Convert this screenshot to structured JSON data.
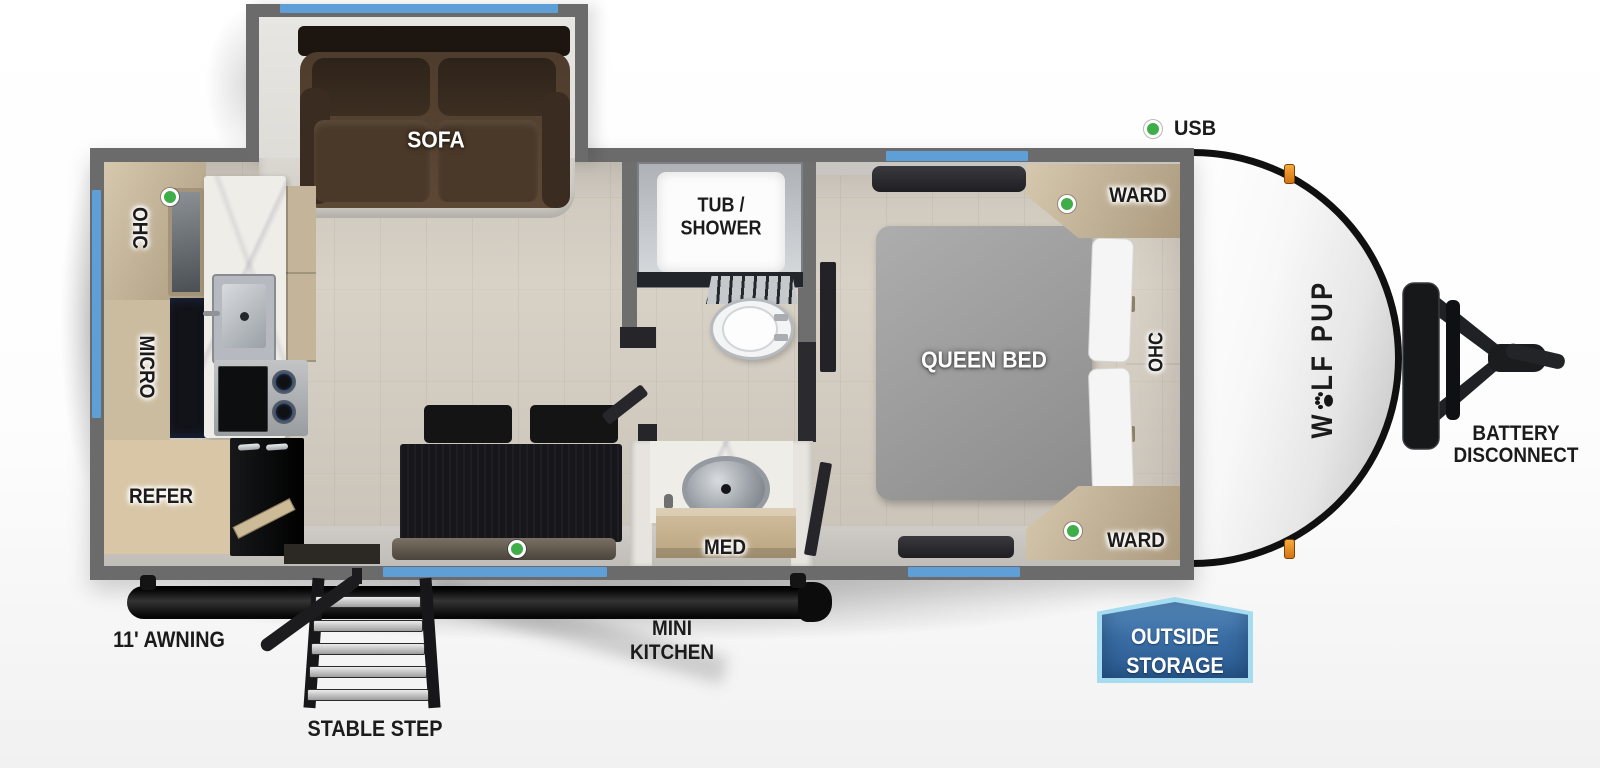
{
  "trailer": {
    "brand_logo": {
      "prefix": "W",
      "suffix": "LF PUP"
    },
    "rooms": {
      "living": {
        "sofa": "SOFA"
      },
      "kitchen": {
        "ohc": "OHC",
        "micro": "MICRO",
        "refer": "REFER"
      },
      "bath": {
        "tub_line1": "TUB /",
        "tub_line2": "SHOWER",
        "med": "MED"
      },
      "bedroom": {
        "bed": "QUEEN BED",
        "ward_top": "WARD",
        "ward_bottom": "WARD",
        "ohc": "OHC"
      }
    },
    "callouts": {
      "usb": "USB",
      "battery_line1": "BATTERY",
      "battery_line2": "DISCONNECT",
      "awning": "11' AWNING",
      "stable_step": "STABLE STEP",
      "mini_kitchen_line1": "MINI",
      "mini_kitchen_line2": "KITCHEN",
      "outside_storage_line1": "OUTSIDE",
      "outside_storage_line2": "STORAGE"
    },
    "colors": {
      "wall": "#6b6b6b",
      "window": "#5f9fd8",
      "usb_marker": "#3fae49",
      "storage_badge_fill": "#35689e",
      "storage_badge_border": "#a5dcf0"
    }
  }
}
